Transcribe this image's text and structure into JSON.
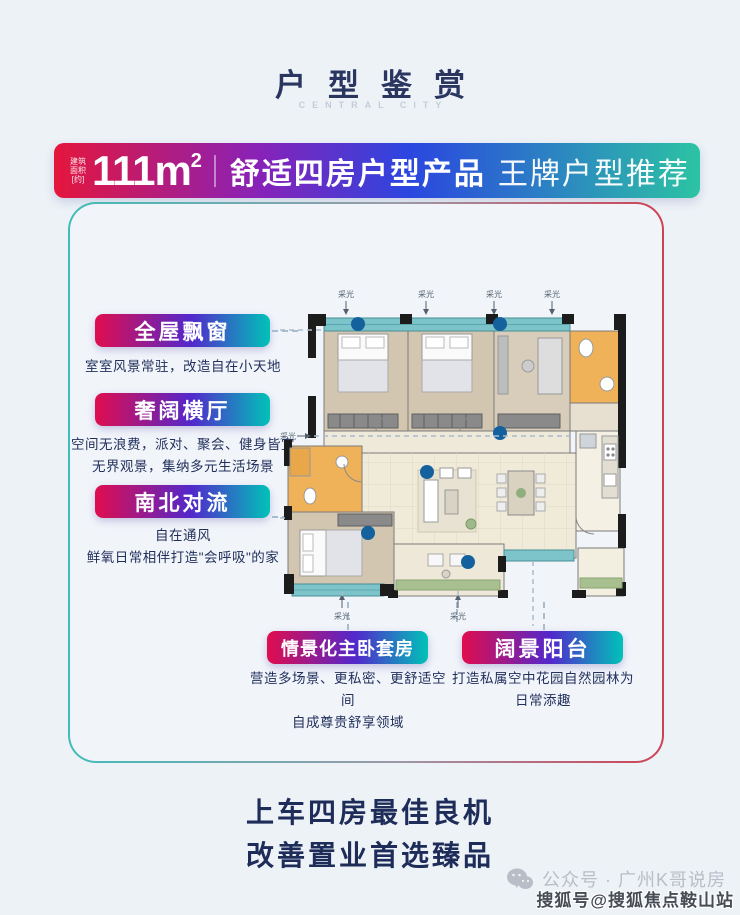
{
  "header": {
    "title": "户型鉴赏",
    "subtitle": "CENTRAL CITY"
  },
  "banner": {
    "area_note": [
      "建筑",
      "面积",
      "[约]"
    ],
    "area_value": "111m",
    "area_sup": "2",
    "headline_primary": "舒适四房户型产品",
    "headline_secondary": "王牌户型推荐"
  },
  "features": [
    {
      "label": "全屋飘窗",
      "desc": [
        "室室风景常驻，改造自在小天地"
      ]
    },
    {
      "label": "奢阔横厅",
      "desc": [
        "空间无浪费，派对、聚会、健身皆宜",
        "无界观景，集纳多元生活场景"
      ]
    },
    {
      "label": "南北对流",
      "desc": [
        "自在通风",
        "鲜氧日常相伴打造\"会呼吸\"的家"
      ]
    },
    {
      "label": "情景化主卧套房",
      "desc": [
        "营造多场景、更私密、更舒适空间",
        "自成尊贵舒享领域"
      ]
    },
    {
      "label": "阔景阳台",
      "desc": [
        "打造私属空中花园自然园林为",
        "日常添趣"
      ]
    }
  ],
  "floorplan": {
    "daylight_label": "采光"
  },
  "slogan": {
    "line1": "上车四房最佳良机",
    "line2": "改善置业首选臻品"
  },
  "footer": {
    "wechat_account": "公众号 · 广州K哥说房",
    "watermark": "搜狐号@搜狐焦点鞍山站"
  },
  "colors": {
    "banner_gradient": [
      "#e4163c",
      "#8722b9",
      "#2b46e0",
      "#2cc3a3"
    ],
    "pill_gradient": [
      "#e00d4e",
      "#5228cc",
      "#00c2b8"
    ],
    "frame_border_gradient": [
      "#41bcb8",
      "#cf4156"
    ],
    "text_dark": "#1d2c58",
    "window_teal": "#7cc4ca",
    "bathroom_orange": "#efb259",
    "bedroom_beige": "#d2c6b0",
    "dot_blue": "#15619e"
  }
}
